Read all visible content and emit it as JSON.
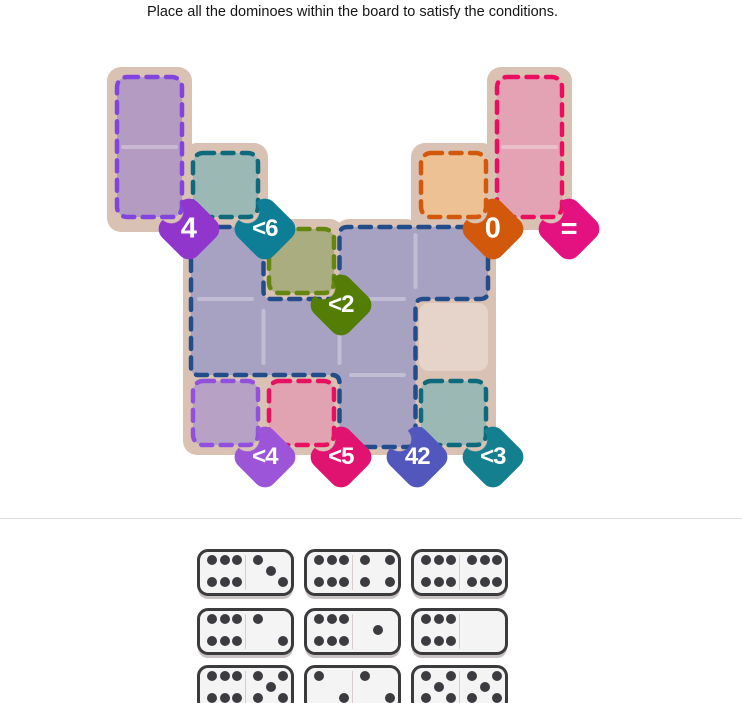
{
  "title": "Place all the dominoes within the board to satisfy the conditions.",
  "board": {
    "board_color": "#d9c2b3",
    "plain_cell_color": "#e6d4cb",
    "plain_cells": [
      [
        4,
        3
      ]
    ],
    "regions": [
      {
        "id": "region-sum-4",
        "badge": "4",
        "badge_color": "#9036cd",
        "fill": "#b39bc1",
        "dash": "#8243df",
        "cells": [
          [
            0,
            0
          ],
          [
            0,
            1
          ]
        ],
        "badge_cell": [
          0,
          1
        ]
      },
      {
        "id": "region-lt-6",
        "badge": "<6",
        "badge_color": "#0d7e95",
        "fill": "#9cb8b5",
        "dash": "#0d6a7d",
        "cells": [
          [
            1,
            1
          ]
        ],
        "badge_cell": [
          1,
          1
        ]
      },
      {
        "id": "region-sum-0",
        "badge": "0",
        "badge_color": "#d2580c",
        "fill": "#edc194",
        "dash": "#d2580c",
        "cells": [
          [
            4,
            1
          ]
        ],
        "badge_cell": [
          4,
          1
        ]
      },
      {
        "id": "region-equal",
        "badge": "=",
        "badge_color": "#e31280",
        "fill": "#e3a3b5",
        "dash": "#eb0e60",
        "cells": [
          [
            5,
            0
          ],
          [
            5,
            1
          ]
        ],
        "badge_cell": [
          5,
          1
        ]
      },
      {
        "id": "region-lt-2",
        "badge": "<2",
        "badge_color": "#537d04",
        "fill": "#aaad7f",
        "dash": "#64860f",
        "cells": [
          [
            2,
            2
          ]
        ],
        "badge_cell": [
          2,
          2
        ]
      },
      {
        "id": "region-sum-42",
        "badge": "42",
        "badge_color": "#5157bd",
        "fill": "#a7a1c2",
        "dash": "#224d8a",
        "cells": [
          [
            1,
            2
          ],
          [
            3,
            2
          ],
          [
            4,
            2
          ],
          [
            1,
            3
          ],
          [
            2,
            3
          ],
          [
            3,
            3
          ],
          [
            3,
            4
          ]
        ],
        "badge_cell": [
          3,
          4
        ]
      },
      {
        "id": "region-lt-4",
        "badge": "<4",
        "badge_color": "#9c55d9",
        "fill": "#b7a2c5",
        "dash": "#9150dd",
        "cells": [
          [
            1,
            4
          ]
        ],
        "badge_cell": [
          1,
          4
        ]
      },
      {
        "id": "region-lt-5",
        "badge": "<5",
        "badge_color": "#e01370",
        "fill": "#e1a2b2",
        "dash": "#e81060",
        "cells": [
          [
            2,
            4
          ]
        ],
        "badge_cell": [
          2,
          4
        ]
      },
      {
        "id": "region-lt-3",
        "badge": "<3",
        "badge_color": "#14808f",
        "fill": "#9cb8b5",
        "dash": "#0d6a7d",
        "cells": [
          [
            4,
            4
          ]
        ],
        "badge_cell": [
          4,
          4
        ]
      }
    ]
  },
  "tray": {
    "dominoes": [
      {
        "left": 6,
        "right": 3
      },
      {
        "left": 6,
        "right": 4
      },
      {
        "left": 6,
        "right": 6
      },
      {
        "left": 6,
        "right": 2
      },
      {
        "left": 6,
        "right": 1
      },
      {
        "left": 6,
        "right": 0
      },
      {
        "left": 6,
        "right": 5
      },
      {
        "left": 2,
        "right": 2
      },
      {
        "left": 5,
        "right": 5
      }
    ]
  }
}
